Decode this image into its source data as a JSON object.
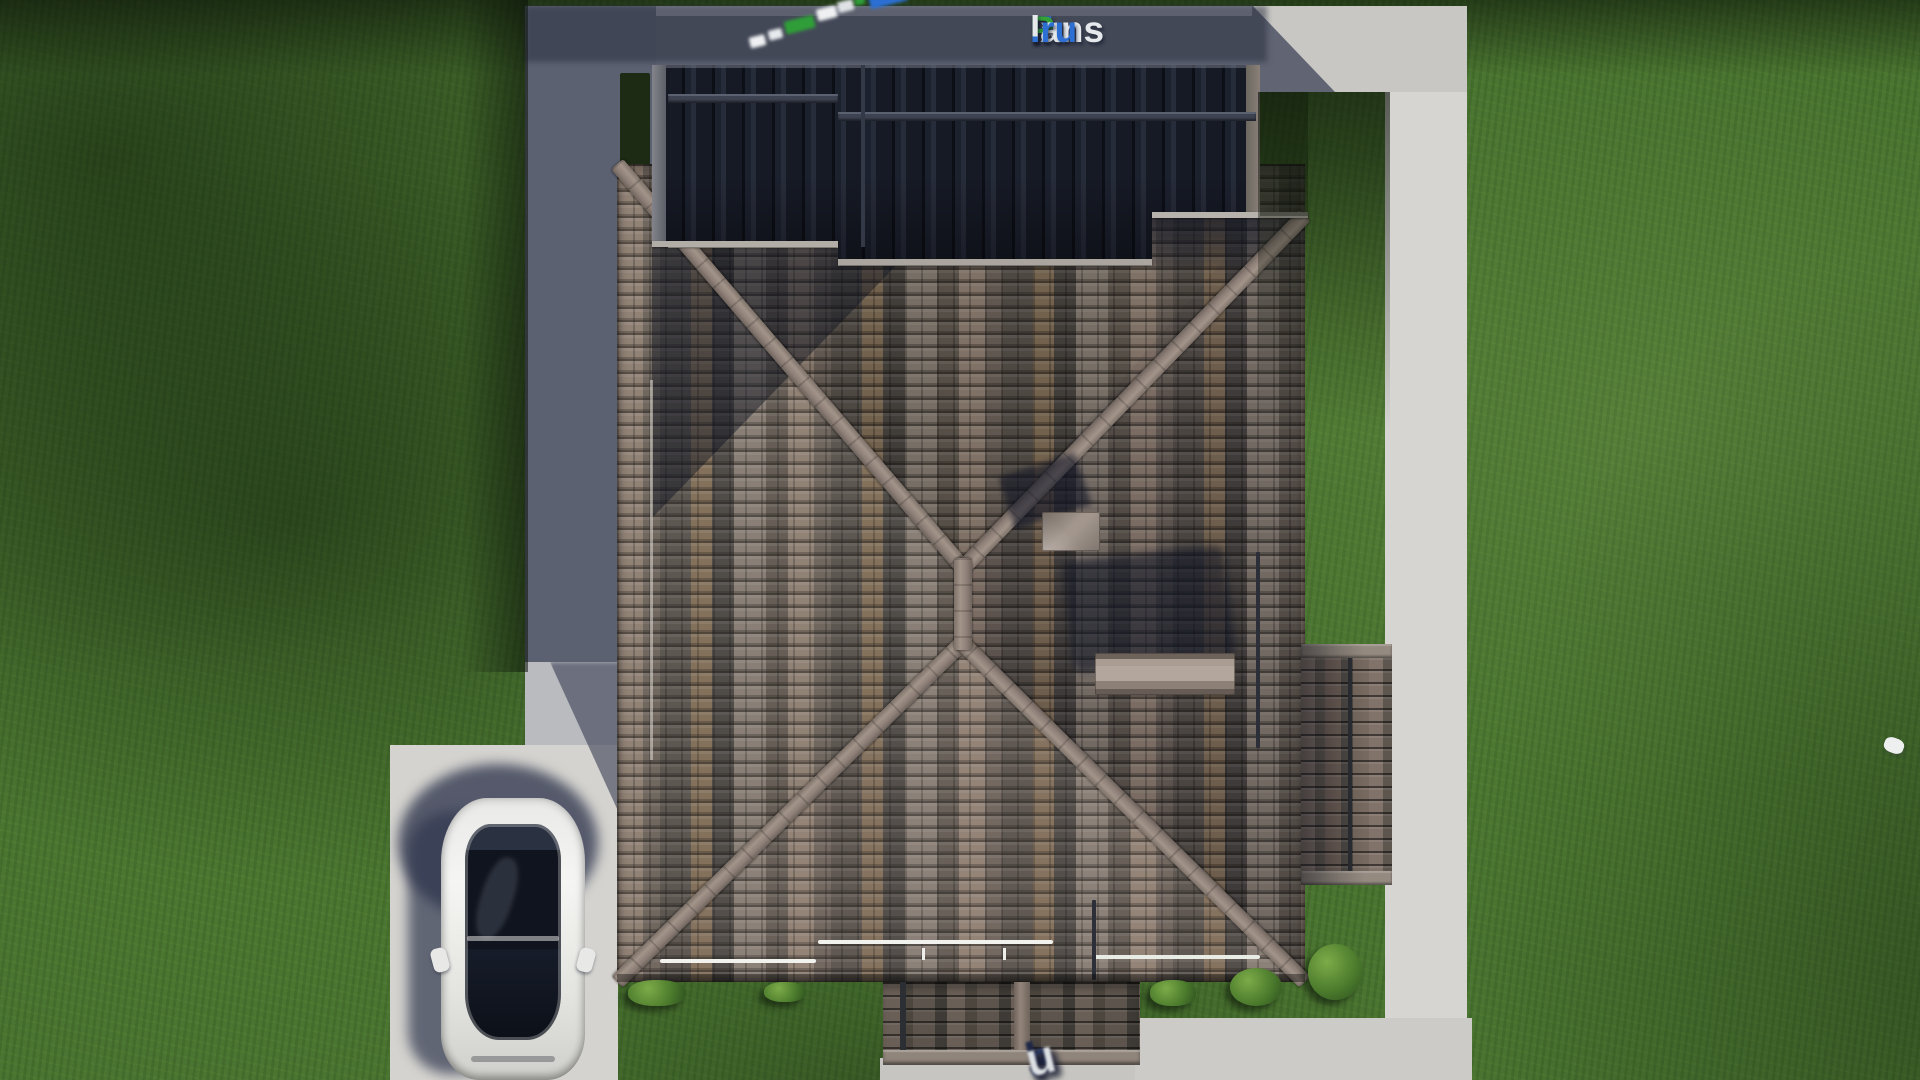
{
  "site": {
    "brand": "FixPlans.ru"
  },
  "watermarks": {
    "logo_top": {
      "segments": [
        {
          "text": "F",
          "tone": "blue",
          "color": "#2d6fd2"
        },
        {
          "text": "ix",
          "tone": "white",
          "color": "#e6e9ec"
        },
        {
          "text": "P",
          "tone": "green",
          "color": "#33a237"
        },
        {
          "text": "lans",
          "tone": "white",
          "color": "#e6e9ec"
        },
        {
          "text": ".ru",
          "tone": "blue",
          "color": "#2d6fd2"
        }
      ]
    },
    "logo_bottom_partial": {
      "note": "blurred tilted watermark cut by bottom edge",
      "segments": [
        {
          "text": "l",
          "tone": "dark",
          "color": "#1d2646"
        },
        {
          "text": "a",
          "tone": "dark",
          "color": "#1d2646"
        },
        {
          "text": "n",
          "tone": "mid",
          "color": "#2b365f"
        },
        {
          "text": "s",
          "tone": "dark",
          "color": "#1d2646"
        },
        {
          "text": ".",
          "tone": "light",
          "color": "#dde1e4"
        },
        {
          "text": "r",
          "tone": "mid",
          "color": "#2b365f"
        },
        {
          "text": "u",
          "tone": "light",
          "color": "#dde1e4"
        }
      ]
    },
    "logo_fragment_blurred": {
      "blocks": [
        "white",
        "white",
        "green",
        "white",
        "white",
        "green",
        "blue"
      ]
    }
  },
  "palette": {
    "grass": "#4a7431",
    "grass_shadow": "#1d2b15",
    "concrete_light": "#d4d3cf",
    "concrete_shadowed": "#565c70",
    "roof_tile_base": "#75695f",
    "roof_ridge": "#a29489",
    "dark_roof": "#151822",
    "chimney_cap": "#a99c93",
    "car_body": "#eceaea",
    "car_glass": "#10141e",
    "bush_green": "#4b7a2c"
  },
  "scene": {
    "description": "Top-down 3D render of a house hip roof with driveway, paths, lawn and parked car",
    "objects": [
      {
        "name": "lawn"
      },
      {
        "name": "back-path"
      },
      {
        "name": "right-path"
      },
      {
        "name": "driveway"
      },
      {
        "name": "terrace-paving"
      },
      {
        "name": "main-hip-roof"
      },
      {
        "name": "dark-upper-roof"
      },
      {
        "name": "annex-roof"
      },
      {
        "name": "porch-roof"
      },
      {
        "name": "chimney-small"
      },
      {
        "name": "chimney-large"
      },
      {
        "name": "white-car"
      },
      {
        "name": "bushes",
        "count": 5
      }
    ]
  }
}
